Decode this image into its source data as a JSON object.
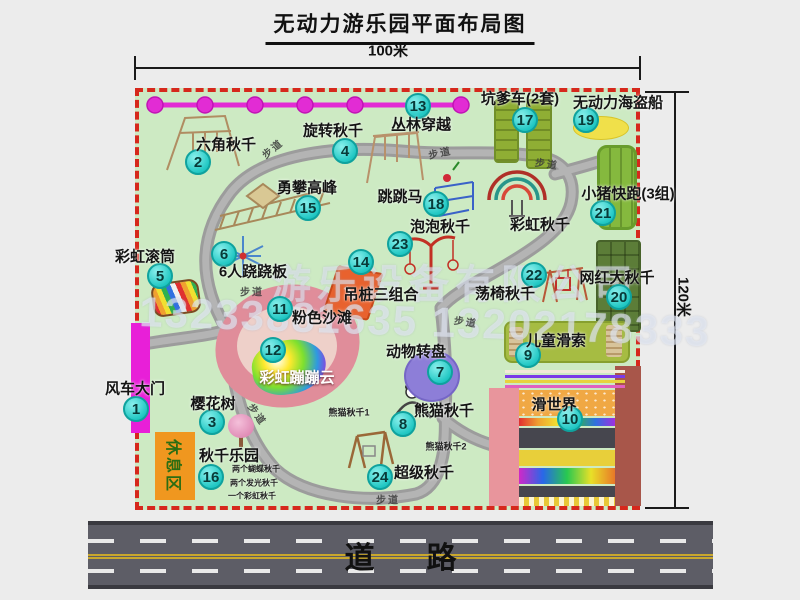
{
  "title": "无动力游乐园平面布局图",
  "dimensions": {
    "width": "100米",
    "height": "120米"
  },
  "road": {
    "label": "道路"
  },
  "watermark": {
    "company": "游乐设备有限公司",
    "phone": "13233881635 13202178333"
  },
  "rest_area_label": "休息区",
  "trail_label": "步道",
  "colors": {
    "park_green": "#cdeac3",
    "border_red": "#d6281c",
    "badge_cyan": "#22c8c4",
    "path_gray": "#9c9c9c",
    "gate_magenta": "#e81fd8",
    "rest_orange": "#f0971f"
  },
  "attractions": [
    {
      "num": "1",
      "name": "风车大门",
      "badge": [
        136,
        409
      ],
      "label": [
        135,
        388
      ]
    },
    {
      "num": "2",
      "name": "六角秋千",
      "badge": [
        198,
        162
      ],
      "label": [
        226,
        144
      ]
    },
    {
      "num": "3",
      "name": "樱花树",
      "badge": [
        212,
        422
      ],
      "label": [
        213,
        403
      ]
    },
    {
      "num": "4",
      "name": "旋转秋千",
      "badge": [
        345,
        151
      ],
      "label": [
        333,
        130
      ]
    },
    {
      "num": "5",
      "name": "彩虹滚筒",
      "badge": [
        160,
        276
      ],
      "label": [
        145,
        256
      ]
    },
    {
      "num": "6",
      "name": "6人跷跷板",
      "badge": [
        224,
        254
      ],
      "label": [
        253,
        271
      ]
    },
    {
      "num": "7",
      "name": "动物转盘",
      "badge": [
        440,
        372
      ],
      "label": [
        416,
        351
      ]
    },
    {
      "num": "8",
      "name": "熊猫秋千",
      "badge": [
        403,
        424
      ],
      "label": [
        444,
        410
      ]
    },
    {
      "num": "9",
      "name": "儿童滑索",
      "badge": [
        528,
        355
      ],
      "label": [
        556,
        340
      ]
    },
    {
      "num": "10",
      "name": "滑世界",
      "badge": [
        570,
        419
      ],
      "label": [
        554,
        404
      ]
    },
    {
      "num": "11",
      "name": "粉色沙滩",
      "badge": [
        280,
        309
      ],
      "label": [
        322,
        317
      ]
    },
    {
      "num": "12",
      "name": "彩虹蹦蹦云",
      "badge": [
        273,
        350
      ],
      "label": [
        297,
        377
      ],
      "white": true
    },
    {
      "num": "13",
      "name": "丛林穿越",
      "badge": [
        418,
        106
      ],
      "label": [
        421,
        124
      ]
    },
    {
      "num": "14",
      "name": "吊桩三组合",
      "badge": [
        361,
        262
      ],
      "label": [
        381,
        294
      ]
    },
    {
      "num": "15",
      "name": "勇攀高峰",
      "badge": [
        308,
        208
      ],
      "label": [
        307,
        187
      ]
    },
    {
      "num": "16",
      "name": "秋千乐园",
      "badge": [
        211,
        477
      ],
      "label": [
        229,
        455
      ]
    },
    {
      "num": "17",
      "name": "坑爹车(2套)",
      "badge": [
        525,
        120
      ],
      "label": [
        520,
        98
      ]
    },
    {
      "num": "18",
      "name": "跳跳马",
      "badge": [
        436,
        204
      ],
      "label": [
        400,
        196
      ]
    },
    {
      "num": "19",
      "name": "无动力海盗船",
      "badge": [
        586,
        120
      ],
      "label": [
        618,
        102
      ]
    },
    {
      "num": "20",
      "name": "网红大秋千",
      "badge": [
        619,
        297
      ],
      "label": [
        617,
        277
      ]
    },
    {
      "num": "21",
      "name": "小猪快跑(3组)",
      "badge": [
        603,
        213
      ],
      "label": [
        628,
        193
      ]
    },
    {
      "num": "22",
      "name": "荡椅秋千",
      "badge": [
        534,
        275
      ],
      "label": [
        505,
        293
      ]
    },
    {
      "num": "23",
      "name": "泡泡秋千",
      "badge": [
        400,
        244
      ],
      "label": [
        440,
        226
      ]
    },
    {
      "num": "24",
      "name": "超级秋千",
      "badge": [
        380,
        477
      ],
      "label": [
        424,
        472
      ]
    },
    {
      "num": "",
      "name": "彩虹秋千",
      "badge": null,
      "label": [
        540,
        224
      ]
    }
  ],
  "notes": [
    {
      "text": "两个蝴蝶秋千",
      "x": 256,
      "y": 469,
      "size": 8
    },
    {
      "text": "两个发光秋千",
      "x": 254,
      "y": 483,
      "size": 8
    },
    {
      "text": "一个彩虹秋千",
      "x": 252,
      "y": 496,
      "size": 8
    },
    {
      "text": "熊猫秋千1",
      "x": 349,
      "y": 412,
      "size": 9
    },
    {
      "text": "熊猫秋千2",
      "x": 446,
      "y": 446,
      "size": 9
    }
  ],
  "trails": [
    {
      "x": 272,
      "y": 148,
      "rot": -40
    },
    {
      "x": 440,
      "y": 152,
      "rot": -12
    },
    {
      "x": 547,
      "y": 163,
      "rot": 8
    },
    {
      "x": 252,
      "y": 291,
      "rot": 0
    },
    {
      "x": 466,
      "y": 321,
      "rot": 8
    },
    {
      "x": 258,
      "y": 414,
      "rot": 55
    },
    {
      "x": 388,
      "y": 499,
      "rot": 0
    }
  ]
}
